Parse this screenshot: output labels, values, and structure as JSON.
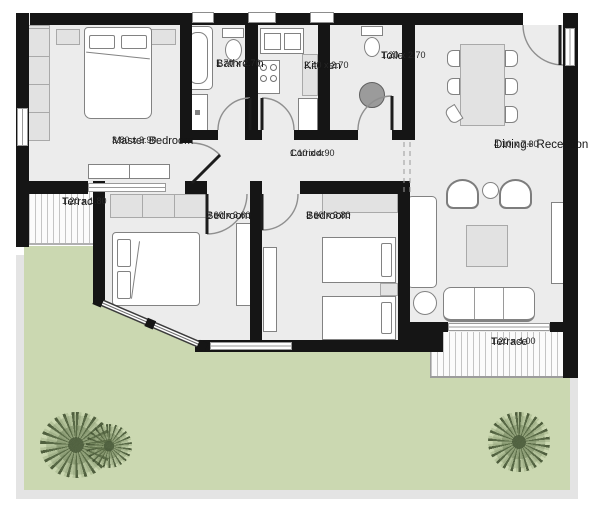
{
  "plan_title": "Apartment floor plan",
  "rooms": [
    {
      "key": "master-bedroom",
      "name": "Master Bedroom",
      "dims": "3.80 x 3.90"
    },
    {
      "key": "bathroom",
      "name": "Bathroom",
      "dims": "1.70 x 2.70"
    },
    {
      "key": "kitchen",
      "name": "Kitchen",
      "dims": "2.40 x 2.70"
    },
    {
      "key": "toilet",
      "name": "Toilet",
      "dims": "1.20 x 2.70"
    },
    {
      "key": "corridor",
      "name": "Corridor",
      "dims": "1.10 x 4.90"
    },
    {
      "key": "dining-reception",
      "name": "Dining+ Reception",
      "dims": "4.10 x 7.30"
    },
    {
      "key": "bedroom-1",
      "name": "Bedroom",
      "dims": "3.60 x 3.60"
    },
    {
      "key": "bedroom-2",
      "name": "Bedroom",
      "dims": "3.60 x 3.80"
    },
    {
      "key": "terrace-left",
      "name": "Terrace",
      "dims": "1.20 x 1.80"
    },
    {
      "key": "terrace-bottom",
      "name": "Terrace",
      "dims": "1.20 x 4.00"
    }
  ],
  "colors": {
    "wall": "#151515",
    "floor": "#ececec",
    "garden": "#cbd8b1",
    "terrace_hatch": "#c4c4c4",
    "furniture_outline": "#828282",
    "label_text": "#141414"
  }
}
